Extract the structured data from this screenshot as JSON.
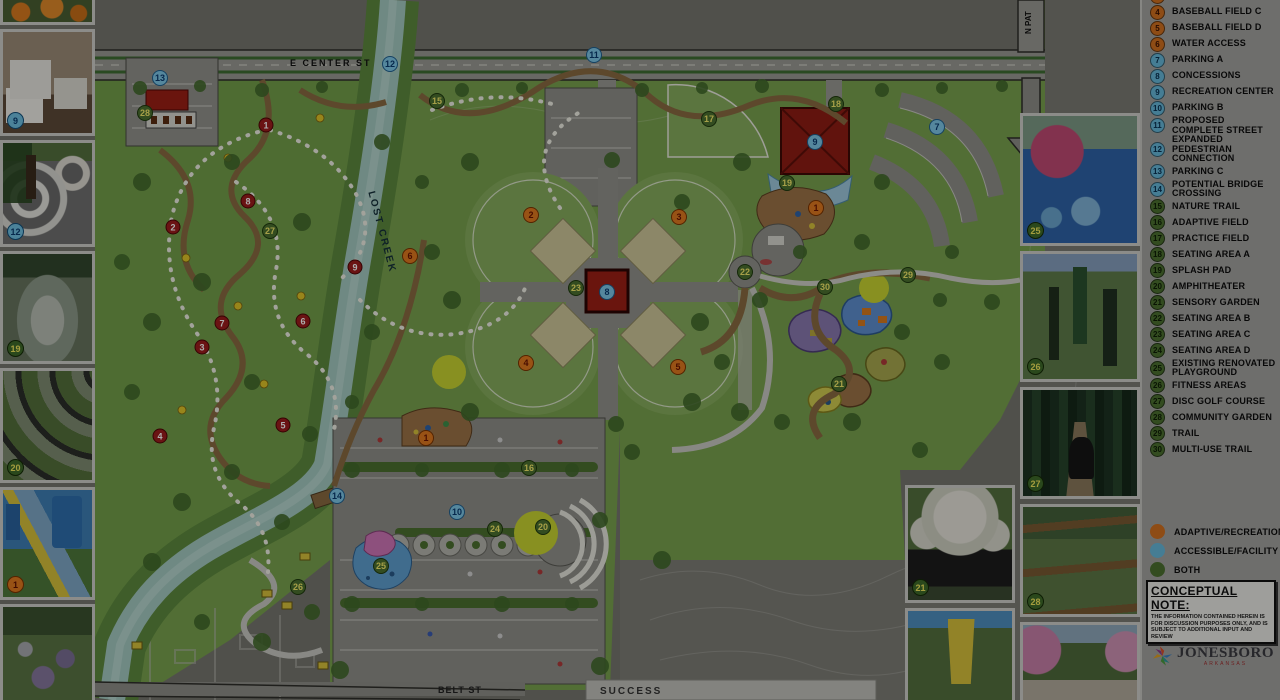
{
  "map": {
    "street_labels": {
      "e_center": "E CENTER ST",
      "lost_creek": "LOST CREEK",
      "belt": "BELT ST",
      "success": "SUCCESS",
      "n_pat": "N PAT"
    },
    "markers": [
      {
        "n": "13",
        "x": 160,
        "y": 78,
        "c": "blue"
      },
      {
        "n": "12",
        "x": 390,
        "y": 64,
        "c": "blue"
      },
      {
        "n": "11",
        "x": 594,
        "y": 55,
        "c": "blue"
      },
      {
        "n": "7",
        "x": 937,
        "y": 127,
        "c": "blue"
      },
      {
        "n": "9",
        "x": 815,
        "y": 142,
        "c": "blue"
      },
      {
        "n": "8",
        "x": 607,
        "y": 292,
        "c": "blue"
      },
      {
        "n": "14",
        "x": 337,
        "y": 496,
        "c": "blue"
      },
      {
        "n": "10",
        "x": 457,
        "y": 512,
        "c": "blue"
      },
      {
        "n": "1",
        "x": 816,
        "y": 208,
        "c": "orange"
      },
      {
        "n": "1",
        "x": 426,
        "y": 438,
        "c": "orange"
      },
      {
        "n": "2",
        "x": 531,
        "y": 215,
        "c": "orange"
      },
      {
        "n": "3",
        "x": 679,
        "y": 217,
        "c": "orange"
      },
      {
        "n": "4",
        "x": 526,
        "y": 363,
        "c": "orange"
      },
      {
        "n": "5",
        "x": 678,
        "y": 367,
        "c": "orange"
      },
      {
        "n": "6",
        "x": 410,
        "y": 256,
        "c": "orange"
      },
      {
        "n": "15",
        "x": 437,
        "y": 101,
        "c": "green"
      },
      {
        "n": "17",
        "x": 709,
        "y": 119,
        "c": "green"
      },
      {
        "n": "18",
        "x": 836,
        "y": 104,
        "c": "green"
      },
      {
        "n": "19",
        "x": 787,
        "y": 183,
        "c": "green"
      },
      {
        "n": "22",
        "x": 745,
        "y": 272,
        "c": "green"
      },
      {
        "n": "23",
        "x": 576,
        "y": 288,
        "c": "green"
      },
      {
        "n": "29",
        "x": 908,
        "y": 275,
        "c": "green"
      },
      {
        "n": "30",
        "x": 825,
        "y": 287,
        "c": "green"
      },
      {
        "n": "21",
        "x": 839,
        "y": 384,
        "c": "green"
      },
      {
        "n": "16",
        "x": 529,
        "y": 468,
        "c": "green"
      },
      {
        "n": "24",
        "x": 495,
        "y": 529,
        "c": "green"
      },
      {
        "n": "20",
        "x": 543,
        "y": 527,
        "c": "green"
      },
      {
        "n": "25",
        "x": 381,
        "y": 566,
        "c": "green"
      },
      {
        "n": "26",
        "x": 298,
        "y": 587,
        "c": "green"
      },
      {
        "n": "27",
        "x": 270,
        "y": 231,
        "c": "green"
      },
      {
        "n": "28",
        "x": 145,
        "y": 113,
        "c": "green"
      },
      {
        "n": "1",
        "x": 266,
        "y": 125,
        "c": "darkred"
      },
      {
        "n": "8",
        "x": 248,
        "y": 201,
        "c": "darkred"
      },
      {
        "n": "2",
        "x": 173,
        "y": 227,
        "c": "darkred"
      },
      {
        "n": "9",
        "x": 355,
        "y": 267,
        "c": "darkred"
      },
      {
        "n": "6",
        "x": 303,
        "y": 321,
        "c": "darkred"
      },
      {
        "n": "7",
        "x": 222,
        "y": 323,
        "c": "darkred"
      },
      {
        "n": "3",
        "x": 202,
        "y": 347,
        "c": "darkred"
      },
      {
        "n": "5",
        "x": 283,
        "y": 425,
        "c": "darkred"
      },
      {
        "n": "4",
        "x": 160,
        "y": 436,
        "c": "darkred"
      }
    ]
  },
  "legend": {
    "items": [
      {
        "n": "3",
        "label": "BASEBALL FIELD B",
        "color": "orange"
      },
      {
        "n": "4",
        "label": "BASEBALL FIELD C",
        "color": "orange"
      },
      {
        "n": "5",
        "label": "BASEBALL FIELD D",
        "color": "orange"
      },
      {
        "n": "6",
        "label": "WATER ACCESS",
        "color": "orange"
      },
      {
        "n": "7",
        "label": "PARKING A",
        "color": "blue"
      },
      {
        "n": "8",
        "label": "CONCESSIONS",
        "color": "blue"
      },
      {
        "n": "9",
        "label": "RECREATION CENTER",
        "color": "blue"
      },
      {
        "n": "10",
        "label": "PARKING B",
        "color": "blue"
      },
      {
        "n": "11",
        "label": "PROPOSED COMPLETE STREET",
        "color": "blue"
      },
      {
        "n": "12",
        "label": "EXPANDED PEDESTRIAN CONNECTION",
        "color": "blue"
      },
      {
        "n": "13",
        "label": "PARKING C",
        "color": "blue"
      },
      {
        "n": "14",
        "label": "POTENTIAL BRIDGE CROSSING",
        "color": "blue"
      },
      {
        "n": "15",
        "label": "NATURE TRAIL",
        "color": "green"
      },
      {
        "n": "16",
        "label": "ADAPTIVE FIELD",
        "color": "green"
      },
      {
        "n": "17",
        "label": "PRACTICE FIELD",
        "color": "green"
      },
      {
        "n": "18",
        "label": "SEATING AREA A",
        "color": "green"
      },
      {
        "n": "19",
        "label": "SPLASH PAD",
        "color": "green"
      },
      {
        "n": "20",
        "label": "AMPHITHEATER",
        "color": "green"
      },
      {
        "n": "21",
        "label": "SENSORY GARDEN",
        "color": "green"
      },
      {
        "n": "22",
        "label": "SEATING AREA B",
        "color": "green"
      },
      {
        "n": "23",
        "label": "SEATING AREA C",
        "color": "green"
      },
      {
        "n": "24",
        "label": "SEATING AREA D",
        "color": "green"
      },
      {
        "n": "25",
        "label": "EXISTING RENOVATED PLAYGROUND",
        "color": "green"
      },
      {
        "n": "26",
        "label": "FITNESS AREAS",
        "color": "green"
      },
      {
        "n": "27",
        "label": "DISC GOLF COURSE",
        "color": "green"
      },
      {
        "n": "28",
        "label": "COMMUNITY GARDEN",
        "color": "green"
      },
      {
        "n": "29",
        "label": "TRAIL",
        "color": "green"
      },
      {
        "n": "30",
        "label": "MULTI-USE TRAIL",
        "color": "green"
      }
    ],
    "key": [
      {
        "label": "ADAPTIVE/RECREATIONAL",
        "color": "#d1701f"
      },
      {
        "label": "ACCESSIBLE/FACILITY",
        "color": "#66b8da"
      },
      {
        "label": "BOTH",
        "color": "#4c7030"
      }
    ],
    "note": {
      "title": "CONCEPTUAL NOTE:",
      "body": "THE INFORMATION CONTAINED HEREIN IS FOR DISCUSSION PURPOSES ONLY, AND IS SUBJECT TO ADDITIONAL INPUT AND REVIEW"
    },
    "logo": {
      "name": "JONESBORO",
      "sub": "ARKANSAS"
    }
  },
  "photos": {
    "left": [
      {
        "style": "ph-pumpkins",
        "badge": "",
        "bc": "none",
        "name": "photo-playground-pumpkins"
      },
      {
        "style": "ph-interior",
        "badge": "9",
        "bc": "blue",
        "name": "photo-adult-changing-room"
      },
      {
        "style": "ph-curvy",
        "badge": "12",
        "bc": "blue",
        "name": "photo-curvy-walkway"
      },
      {
        "style": "ph-splash",
        "badge": "19",
        "bc": "green",
        "name": "photo-splash-fountain"
      },
      {
        "style": "ph-amphi",
        "badge": "20",
        "bc": "green",
        "name": "photo-amphitheater"
      },
      {
        "style": "ph-slide",
        "badge": "1",
        "bc": "orange",
        "name": "photo-accessible-playground-slide"
      },
      {
        "style": "ph-flowers",
        "badge": "",
        "bc": "none",
        "name": "photo-flower-garden"
      }
    ],
    "right_a": [
      {
        "style": "ph-pinkplay",
        "badge": "25",
        "bc": "green",
        "name": "photo-renovated-playground"
      },
      {
        "style": "ph-fitness",
        "badge": "26",
        "bc": "green",
        "name": "photo-accessible-fitness"
      },
      {
        "style": "ph-forest",
        "badge": "27",
        "bc": "green",
        "name": "photo-disc-golf"
      },
      {
        "style": "ph-beds",
        "badge": "28",
        "bc": "green",
        "name": "photo-community-garden-beds"
      },
      {
        "style": "ph-blossom",
        "badge": "",
        "bc": "none",
        "name": "photo-blossom-trail"
      }
    ],
    "right_b": [
      {
        "style": "ph-bench",
        "badge": "21",
        "bc": "green",
        "name": "photo-sensory-garden-bench"
      },
      {
        "style": "ph-swing",
        "badge": "",
        "bc": "none",
        "name": "photo-adaptive-swing"
      }
    ]
  },
  "colors": {
    "adaptive": "#d1701f",
    "accessible": "#66b8da",
    "both": "#4c7030"
  }
}
